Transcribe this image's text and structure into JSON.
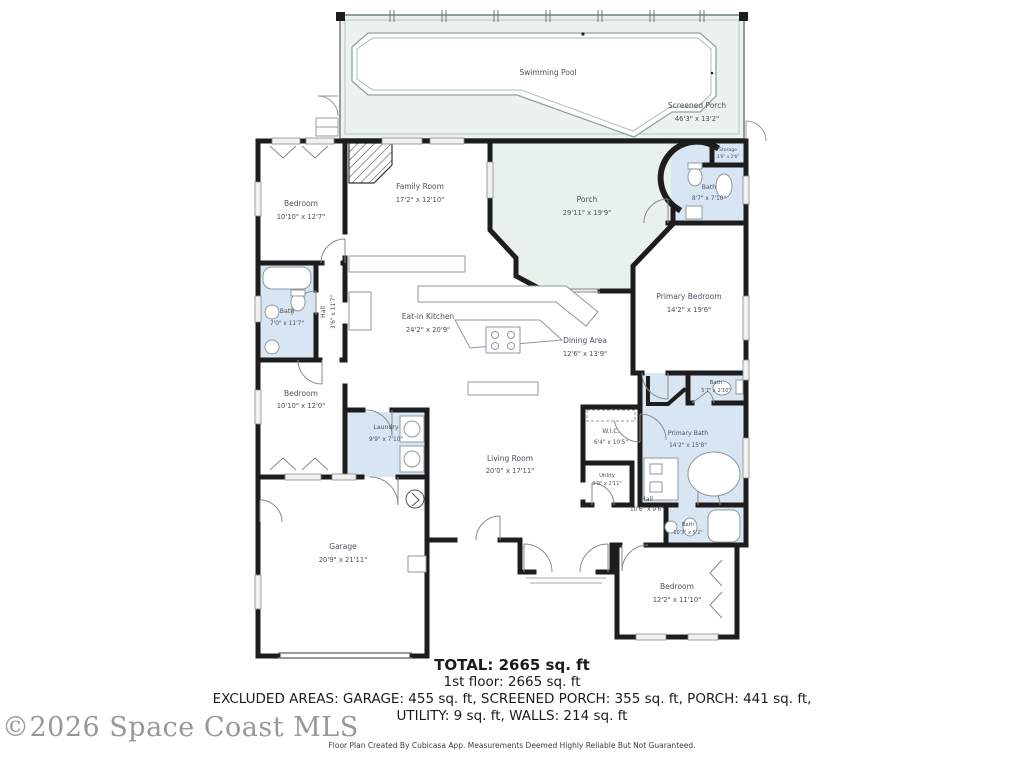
{
  "watermark": "©2026 Space Coast MLS",
  "footer": "Floor Plan Created By Cubicasa App. Measurements Deemed Highly Reliable But Not Guaranteed.",
  "summary": {
    "total": "TOTAL: 2665 sq. ft",
    "first_floor": "1st floor: 2665 sq. ft",
    "excluded_line1": "EXCLUDED AREAS: GARAGE: 455 sq. ft, SCREENED PORCH: 355 sq. ft, PORCH: 441 sq. ft,",
    "excluded_line2": "UTILITY: 9 sq. ft, WALLS: 214 sq. ft"
  },
  "colors": {
    "wall": "#1d1d1d",
    "bath_blue": "#d8e6f3",
    "porch_green": "#e9f1ec",
    "label_gray": "#47525c"
  },
  "rooms": [
    {
      "name": "Swimming Pool",
      "dims": ""
    },
    {
      "name": "Screened Porch",
      "dims": "46'3\" x 13'2\""
    },
    {
      "name": "Family Room",
      "dims": "17'2\" x 12'10\""
    },
    {
      "name": "Porch",
      "dims": "29'11\" x 19'9\""
    },
    {
      "name": "Storage",
      "dims": "3'6\" x 2'6\""
    },
    {
      "name": "Bath",
      "dims": "8'7\" x 7'10\""
    },
    {
      "name": "Bedroom",
      "dims": "10'10\" x 12'7\""
    },
    {
      "name": "Bath",
      "dims": "7'0\" x 11'7\""
    },
    {
      "name": "Hall",
      "dims": "3'6\" x 11'7\""
    },
    {
      "name": "Eat-in Kitchen",
      "dims": "24'2\" x 20'9\""
    },
    {
      "name": "Dining Area",
      "dims": "12'6\" x 13'9\""
    },
    {
      "name": "Primary Bedroom",
      "dims": "14'2\" x 19'6\""
    },
    {
      "name": "Bedroom",
      "dims": "10'10\" x 12'0\""
    },
    {
      "name": "Laundry",
      "dims": "9'9\" x 7'10\""
    },
    {
      "name": "Living Room",
      "dims": "20'0\" x 17'11\""
    },
    {
      "name": "W.I.C.",
      "dims": "6'4\" x 10'5\""
    },
    {
      "name": "Utility",
      "dims": "3'0\" x 2'11\""
    },
    {
      "name": "Primary Bath",
      "dims": "14'2\" x 15'8\""
    },
    {
      "name": "Bath",
      "dims": "5'7\" x 2'10\""
    },
    {
      "name": "Hall",
      "dims": "10'6\" x 9'6\""
    },
    {
      "name": "Bath",
      "dims": "10'3\" x 5'2\""
    },
    {
      "name": "Garage",
      "dims": "20'9\" x 21'11\""
    },
    {
      "name": "Bedroom",
      "dims": "12'2\" x 11'10\""
    }
  ]
}
